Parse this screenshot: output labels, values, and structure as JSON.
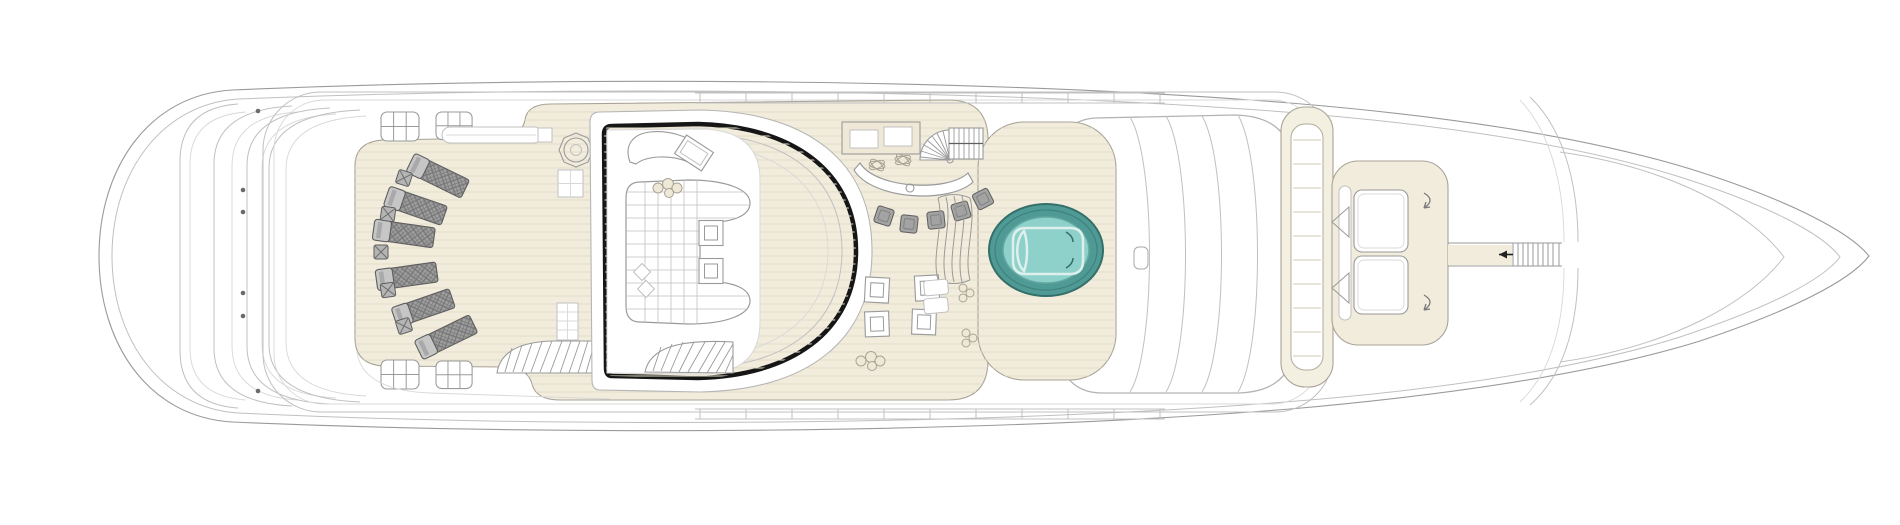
{
  "document": {
    "kind": "yacht-deck-plan",
    "view": "top-down"
  },
  "palette": {
    "paper": "#ffffff",
    "line": "#9a9a9a",
    "line-light": "#c0c0c0",
    "line-faint": "#d8d8d8",
    "black": "#161616",
    "teak": "#f1ecdc",
    "teak-line": "#e2dcc8",
    "teak-edge": "#a9a396",
    "beige2": "#efe8d6",
    "gray-fill": "#9f9f9f",
    "gray-dark": "#5e5e5e",
    "gray-mid": "#7a7a7a",
    "gray-light": "#c6c6c6",
    "teal-rim": "#4f9a94",
    "teal-rim-dark": "#356f6a",
    "teal-water": "#8ed1ca",
    "teal-water-edge": "#63a8a1",
    "seat-line": "#def0ec"
  },
  "features": {
    "sun_loungers": 6,
    "lounger_side_tables": 5,
    "bar_stools": 5,
    "deck_chairs": 4,
    "jacuzzi_pools": 1,
    "staircases": 4,
    "bow_sunpads": 2,
    "enclosed_lounge": 1
  }
}
